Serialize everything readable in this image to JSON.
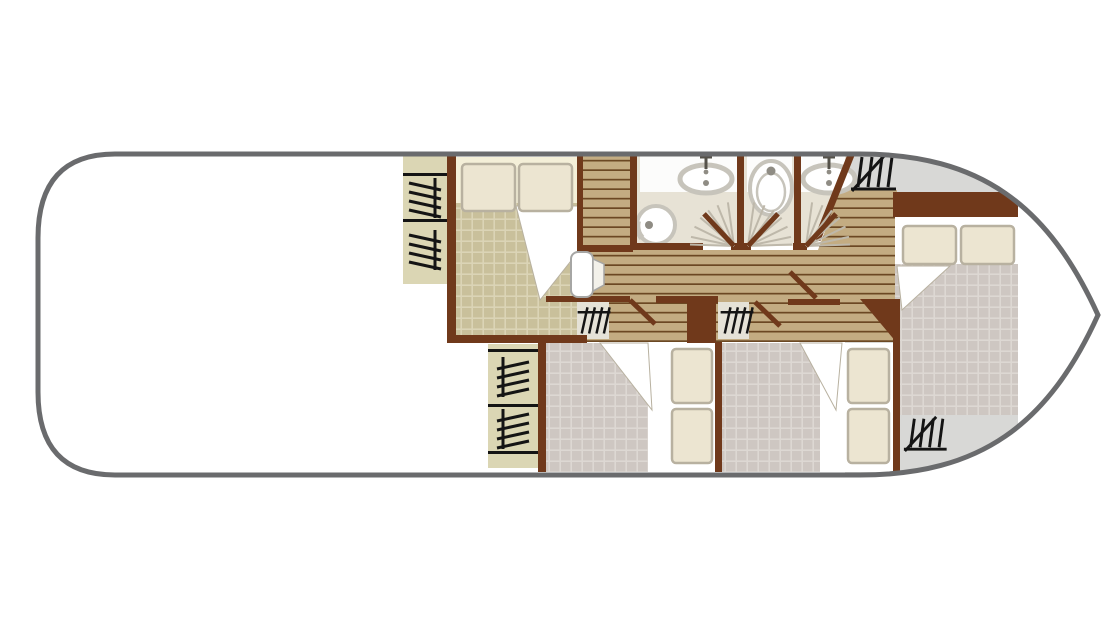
{
  "canvas": {
    "width": 1120,
    "height": 640,
    "background": "#ffffff"
  },
  "colors": {
    "hull": "#6A6B6D",
    "wall": "#70391B",
    "plank": "#C3AC82",
    "plankLine": "#6B4823",
    "blanketKhaki": "#C9C09B",
    "blanketKhakiLine": "#DBD4B6",
    "blanketTaupe": "#CEC7C2",
    "blanketTaupeLine": "#DDD8D3",
    "pillow": "#ECE5D1",
    "pillowEdge": "#B8B1A0",
    "sheetCream": "#F4EFD8",
    "wardrobe": "#DBD6B4",
    "closet": "#E5E2D7",
    "bathFloor": "#E7E2D5",
    "bathWhite": "#FCFCFB",
    "fixtureRim": "#C7C4BB",
    "fixtureDot": "#8F8C84",
    "deck": "#D8D8D6",
    "glyph": "#141414",
    "fanRay": "#BEB8AA",
    "doorEdge": "#A6A6A4"
  },
  "plan": {
    "type": "boat-floor-plan",
    "rooms": [
      {
        "name": "saloon-open-area",
        "furniture": []
      },
      {
        "name": "forward-cabin",
        "furniture": [
          "double-bed",
          "wardrobe",
          "wardrobe"
        ]
      },
      {
        "name": "corridor",
        "furniture": [
          "end-door",
          "door-leaves"
        ]
      },
      {
        "name": "bathroom-forward",
        "furniture": [
          "washbasin",
          "toilet",
          "swing-door"
        ]
      },
      {
        "name": "wc-compartment",
        "furniture": [
          "toilet",
          "swing-door"
        ]
      },
      {
        "name": "bathroom-aft",
        "furniture": [
          "washbasin",
          "swing-door"
        ]
      },
      {
        "name": "cabin-port",
        "furniture": [
          "double-bed",
          "closet",
          "wardrobe",
          "wardrobe"
        ]
      },
      {
        "name": "cabin-starboard",
        "furniture": [
          "double-bed",
          "closet"
        ]
      },
      {
        "name": "bow-cabin",
        "furniture": [
          "double-bed",
          "headboard-locker"
        ]
      },
      {
        "name": "bow-deck",
        "furniture": [
          "companionway-ladder",
          "companionway-ladder"
        ]
      }
    ]
  }
}
